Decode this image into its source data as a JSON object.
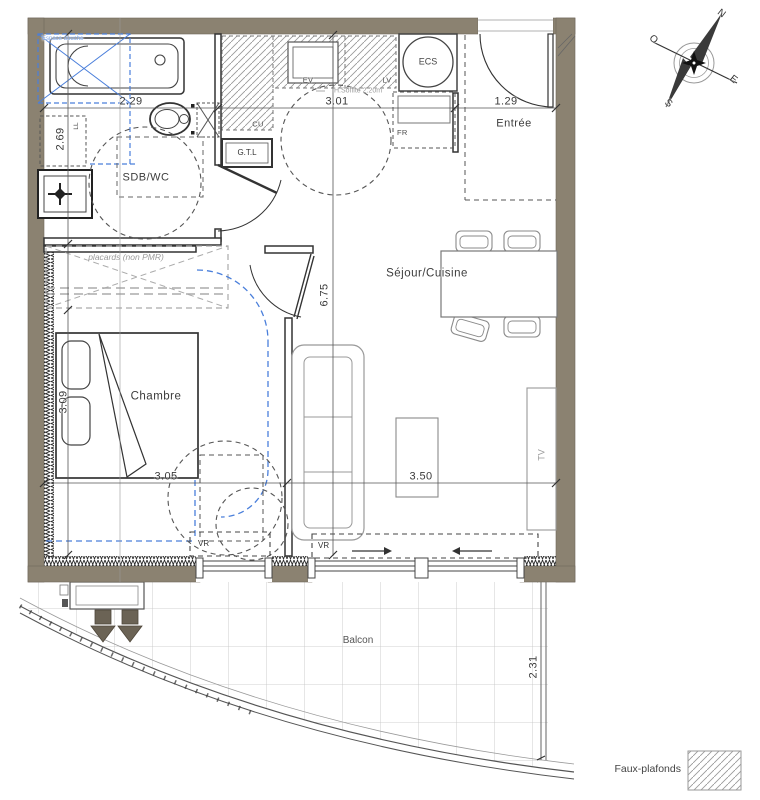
{
  "plan": {
    "rooms": {
      "sdb_wc": "SDB/WC",
      "chambre": "Chambre",
      "sejour_cuisine": "Séjour/Cuisine",
      "entree": "Entrée",
      "balcon": "Balcon"
    },
    "fixtures": {
      "gtl": "G.T.L",
      "ecs": "ECS",
      "ev": "EV",
      "lv": "LV",
      "cu": "CU",
      "fr": "FR",
      "ll": "LL",
      "tv": "TV",
      "vr_chambre": "VR",
      "vr_sejour": "VR"
    },
    "annotations": {
      "espace_douche": "Espace douche",
      "placards": "placards (non PMR)",
      "ceiling_height": "H.Soffite 2.20m"
    },
    "dimensions": {
      "sdb_width": "2.29",
      "sdb_height": "2.69",
      "cuisine_width": "3.01",
      "entree_width": "1.29",
      "sejour_height": "6.75",
      "chambre_height": "3.09",
      "chambre_width": "3.05",
      "sejour_width": "3.50",
      "balcon_depth": "2.31"
    },
    "compass": {
      "north": "N",
      "west": "O",
      "east": "E",
      "south": "S"
    },
    "legend": {
      "faux_plafonds": "Faux-plafonds"
    },
    "colors": {
      "wall": "#8b8271",
      "accent_blue": "#4a7fdb",
      "hatch_gray": "#9a9a9a"
    }
  }
}
